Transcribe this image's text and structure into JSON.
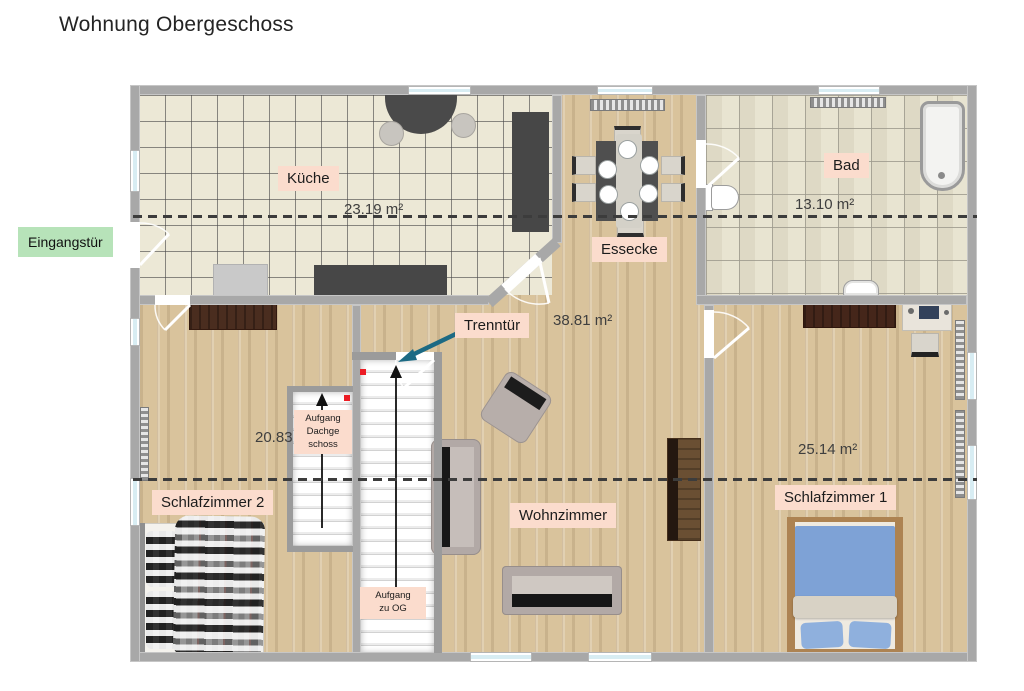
{
  "title": "Wohnung Obergeschoss",
  "entrance": {
    "label": "Eingangstür"
  },
  "rooms": {
    "kitchen": {
      "name": "Küche",
      "area": "23.19 m²"
    },
    "dining": {
      "name": "Essecke"
    },
    "bath": {
      "name": "Bad",
      "area": "13.10 m²"
    },
    "bedroom2": {
      "name": "Schlafzimmer 2",
      "area": "20.83"
    },
    "living": {
      "name": "Wohnzimmer",
      "area": "38.81 m²"
    },
    "bedroom1": {
      "name": "Schlafzimmer 1",
      "area": "25.14 m²"
    }
  },
  "annotations": {
    "separating_door": "Trenntür",
    "stairs_attic": "Aufgang\nDachge\nschoss",
    "stairs_og": "Aufgang\nzu OG"
  },
  "colors": {
    "entrance_label_bg": "#b7e3b9",
    "room_label_bg": "#fbdccd",
    "wall_gray": "#a8a8a8",
    "arrow_teal": "#1c6a84",
    "marker_red": "#ec1c24",
    "dashed_line": "#3c3c3c",
    "bed_blue": "#7ea2d6"
  }
}
